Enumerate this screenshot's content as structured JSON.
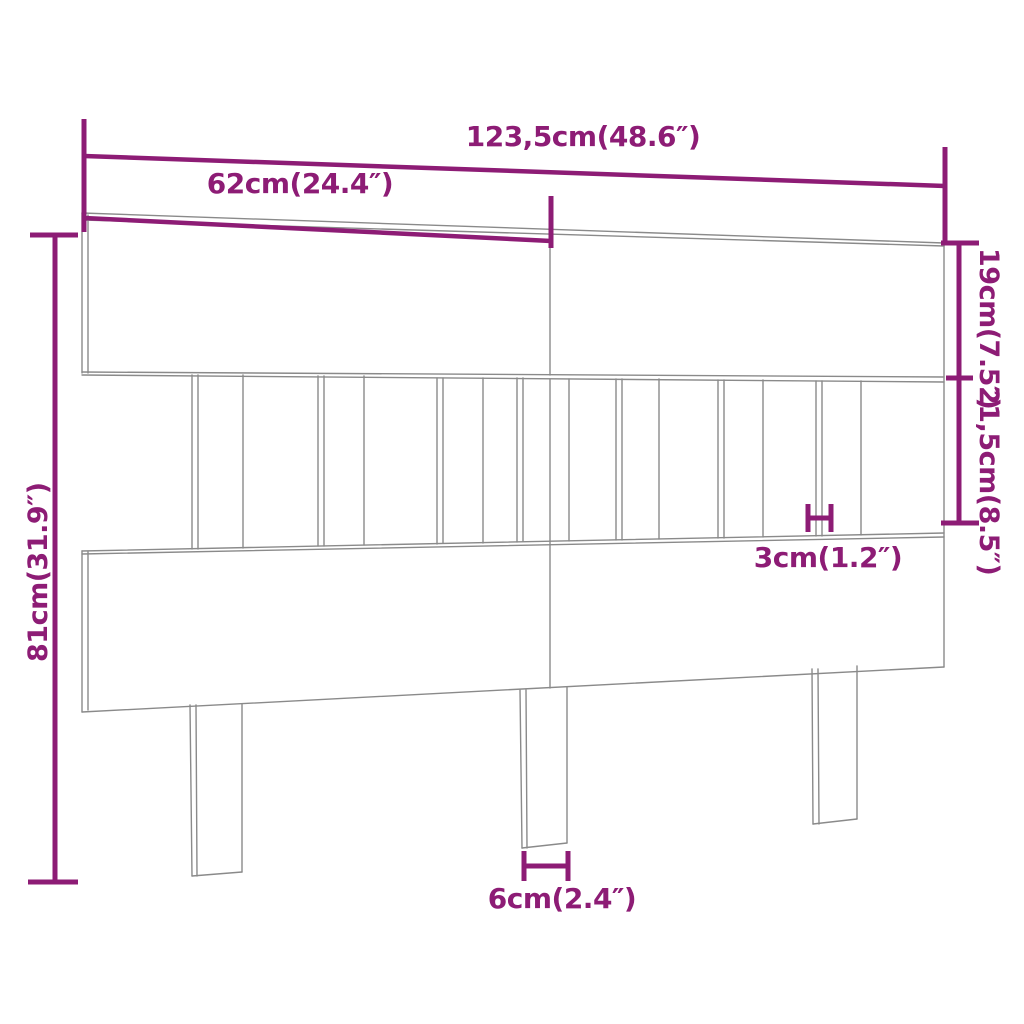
{
  "diagram": {
    "type": "furniture-dimension-drawing",
    "subject": "bed-headboard",
    "colors": {
      "dimension": "#8d1c75",
      "outline": "#8a8a8a",
      "background": "#ffffff"
    },
    "dimensions": {
      "total_width": {
        "label": "123,5cm(48.6″)"
      },
      "half_width": {
        "label": "62cm(24.4″)"
      },
      "top_board_height": {
        "label": "19cm(7.5″)"
      },
      "slat_section_height": {
        "label": "21,5cm(8.5″)"
      },
      "total_height": {
        "label": "81cm(31.9″)"
      },
      "slat_thickness": {
        "label": "3cm(1.2″)"
      },
      "leg_width": {
        "label": "6cm(2.4″)"
      }
    }
  }
}
